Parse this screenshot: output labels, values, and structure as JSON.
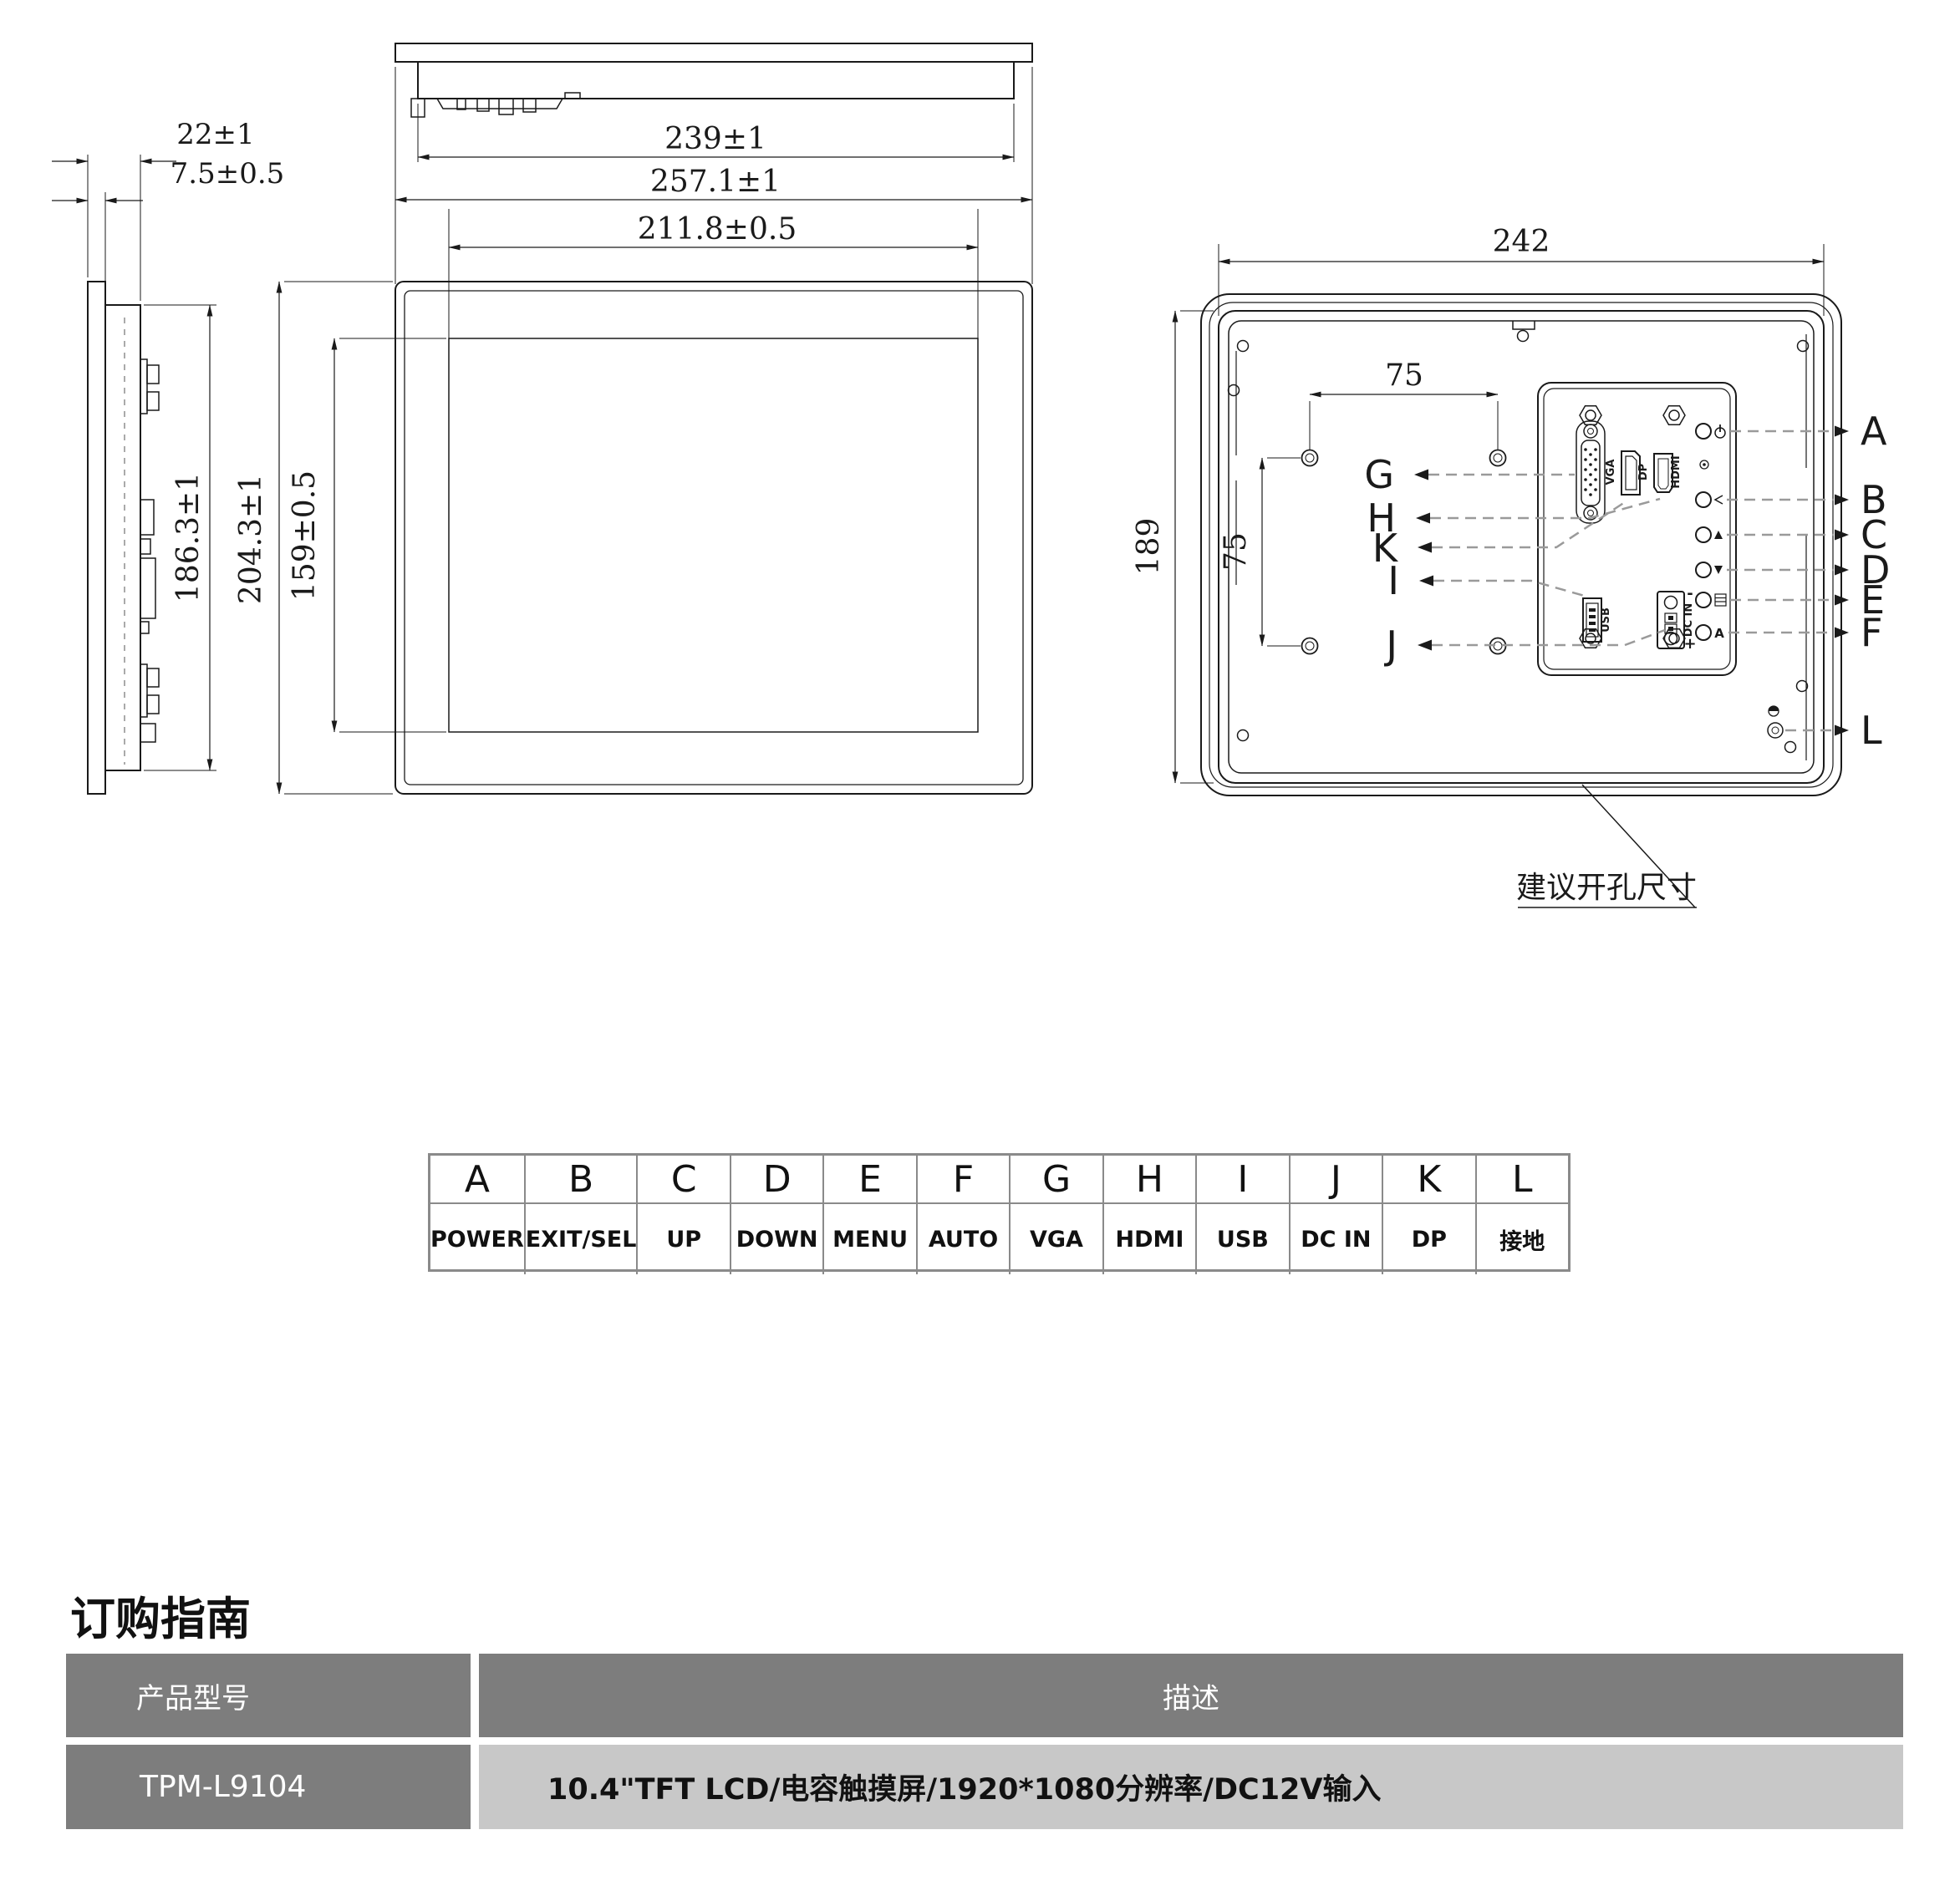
{
  "colors": {
    "line": "#1a1a1a",
    "leader_dash": "#9a9a9a",
    "table_border": "#8a8a8a",
    "order_header_bg": "#7d7d7d",
    "order_cell_bg": "#c8c8c8"
  },
  "drawing": {
    "top_view": {
      "dim_chassis_width": "239±1",
      "dim_glass_width": "257.1±1",
      "dim_active_width": "211.8±0.5"
    },
    "side_view": {
      "dim_depth_total": "22±1",
      "dim_depth_front": "7.5±0.5",
      "dim_chassis_height": "186.3±1",
      "dim_glass_height": "204.3±1",
      "dim_active_height": "159±0.5"
    },
    "back_view": {
      "dim_cutout_width": "242",
      "dim_cutout_height": "189",
      "dim_vesa_horizontal": "75",
      "dim_vesa_vertical": "75",
      "cutout_note": "建议开孔尺寸",
      "left_callouts": [
        "G",
        "H",
        "K",
        "I",
        "J"
      ],
      "right_callouts": [
        "A",
        "B",
        "C",
        "D",
        "E",
        "F"
      ],
      "ground_callout": "L",
      "ports": {
        "vga": "VGA",
        "dp": "DP",
        "hdmi": "HDMI",
        "usb": "USB",
        "dc_in": "DC IN",
        "dc_minus": "-",
        "dc_plus": "+"
      },
      "auto_mark": "A"
    }
  },
  "legend_table": {
    "headers": [
      "A",
      "B",
      "C",
      "D",
      "E",
      "F",
      "G",
      "H",
      "I",
      "J",
      "K",
      "L"
    ],
    "values": [
      "POWER",
      "EXIT/SEL",
      "UP",
      "DOWN",
      "MENU",
      "AUTO",
      "VGA",
      "HDMI",
      "USB",
      "DC IN",
      "DP",
      "接地"
    ]
  },
  "ordering": {
    "title": "订购指南",
    "model_header": "产品型号",
    "desc_header": "描述",
    "model": "TPM-L9104",
    "description": "10.4\"TFT LCD/电容触摸屏/1920*1080分辨率/DC12V输入"
  }
}
